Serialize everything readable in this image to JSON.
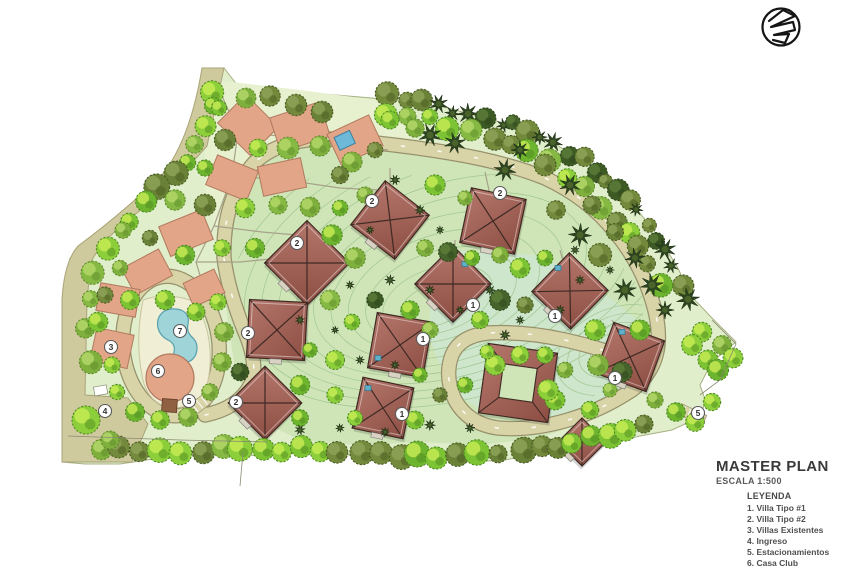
{
  "document": {
    "title": "MASTER PLAN",
    "scale_label": "ESCALA 1:500"
  },
  "legend": {
    "heading": "LEYENDA",
    "items": [
      {
        "num": "1",
        "label": "Villa Tipo #1"
      },
      {
        "num": "2",
        "label": "Villa Tipo #2"
      },
      {
        "num": "3",
        "label": "Villas Existentes"
      },
      {
        "num": "4",
        "label": "Ingreso"
      },
      {
        "num": "5",
        "label": "Estacionamientos"
      },
      {
        "num": "6",
        "label": "Casa Club"
      },
      {
        "num": "7",
        "label": "Area Piscina"
      }
    ]
  },
  "plan": {
    "markers": [
      {
        "n": "2",
        "x": 297,
        "y": 243
      },
      {
        "n": "2",
        "x": 372,
        "y": 201
      },
      {
        "n": "2",
        "x": 500,
        "y": 193
      },
      {
        "n": "2",
        "x": 248,
        "y": 333
      },
      {
        "n": "2",
        "x": 236,
        "y": 402
      },
      {
        "n": "1",
        "x": 473,
        "y": 305
      },
      {
        "n": "1",
        "x": 555,
        "y": 316
      },
      {
        "n": "1",
        "x": 615,
        "y": 378
      },
      {
        "n": "1",
        "x": 423,
        "y": 339
      },
      {
        "n": "1",
        "x": 402,
        "y": 414
      },
      {
        "n": "3",
        "x": 111,
        "y": 347
      },
      {
        "n": "4",
        "x": 105,
        "y": 411
      },
      {
        "n": "5",
        "x": 189,
        "y": 401
      },
      {
        "n": "5",
        "x": 698,
        "y": 413
      },
      {
        "n": "6",
        "x": 158,
        "y": 371
      },
      {
        "n": "7",
        "x": 180,
        "y": 331
      }
    ]
  },
  "colors": {
    "terrain": "#e0eecb",
    "meadow": "#cfe5b8",
    "mint": "#cde6cc",
    "existing_zone": "#e7f0cf",
    "road": "#d9d3a8",
    "road_left": "#cfca9d",
    "roof_light": "#b4766b",
    "roof_dark": "#8d4e43",
    "existing_villa": "#e2a587",
    "pool_water": "#9fd4d8",
    "deck": "#f1eed6",
    "tree_lime": "#7cc433",
    "tree_dark": "#2d4420",
    "title_text": "#3a3a3a"
  }
}
